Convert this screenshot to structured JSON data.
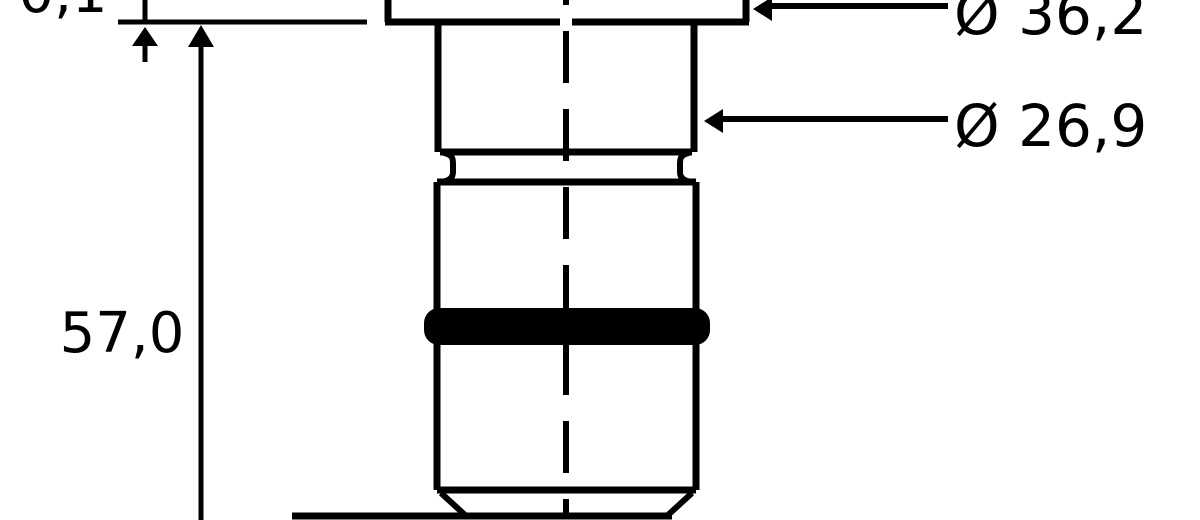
{
  "drawing": {
    "type": "technical-drawing",
    "background_color": "#ffffff",
    "line_color": "#000000",
    "oring_fill_color": "#000000",
    "labels": {
      "flange_thickness": "0,1",
      "overall_length": "57,0",
      "flange_diameter": "Ø 36,2",
      "body_diameter": "Ø 26,9"
    }
  }
}
